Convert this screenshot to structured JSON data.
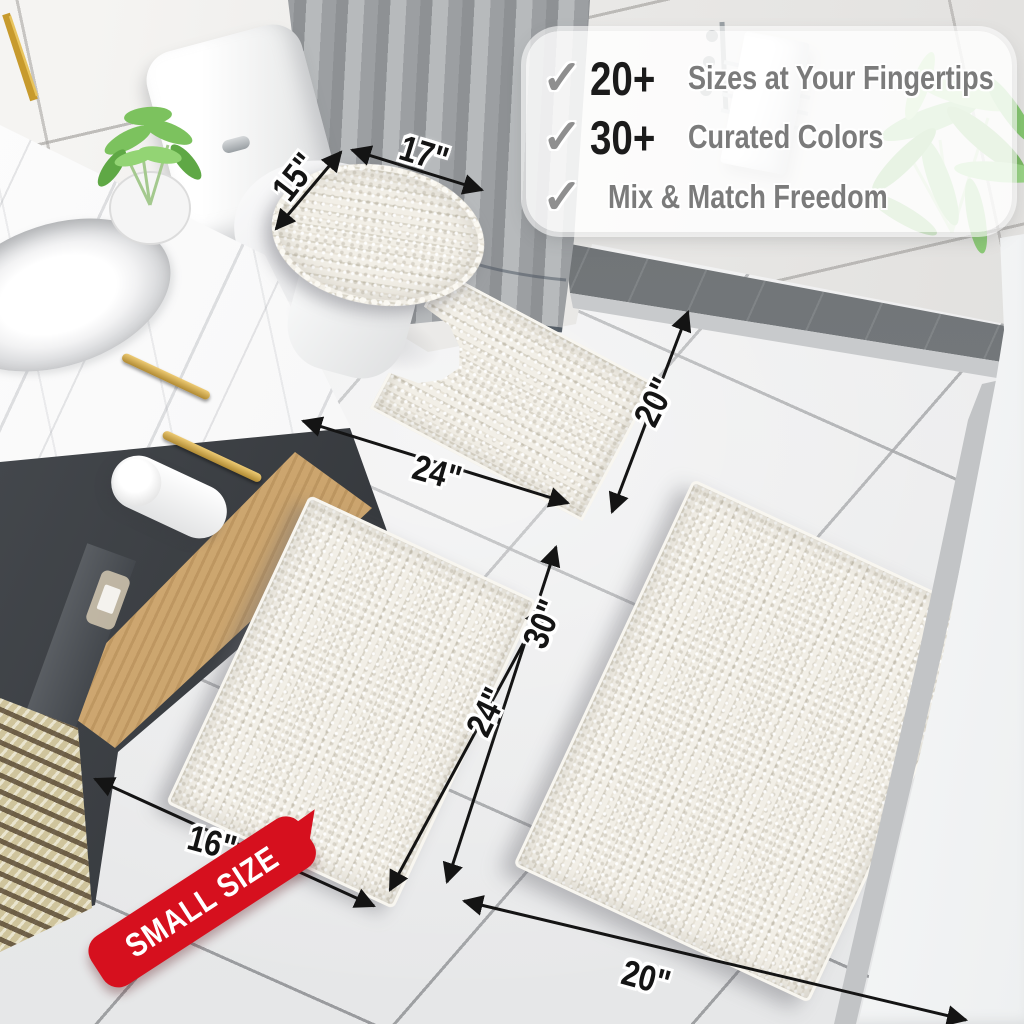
{
  "callout": {
    "check": "✓",
    "items": [
      {
        "stat": "20+",
        "label": "Sizes at Your Fingertips"
      },
      {
        "stat": "30+",
        "label": "Curated Colors"
      },
      {
        "stat": "",
        "label": "Mix & Match Freedom"
      }
    ]
  },
  "dims": {
    "lid_width": "17\"",
    "lid_depth": "15\"",
    "contour_width": "24\"",
    "contour_depth": "20\"",
    "small_width": "16\"",
    "small_length": "24\"",
    "large_length": "30\"",
    "large_width": "20\""
  },
  "badge": {
    "label": "SMALL SIZE"
  },
  "colors": {
    "badge_red": "#d6101e",
    "rug_cream": "#f2efe7",
    "stat_black": "#1b1b1b",
    "feature_gray": "#7b7b7b",
    "check_gray": "#8f8f8f",
    "dimension_black": "#141414",
    "vanity_charcoal": "#303337",
    "shelf_wood": "#c9a36f",
    "curtain_gray": "#9c9fa2"
  }
}
